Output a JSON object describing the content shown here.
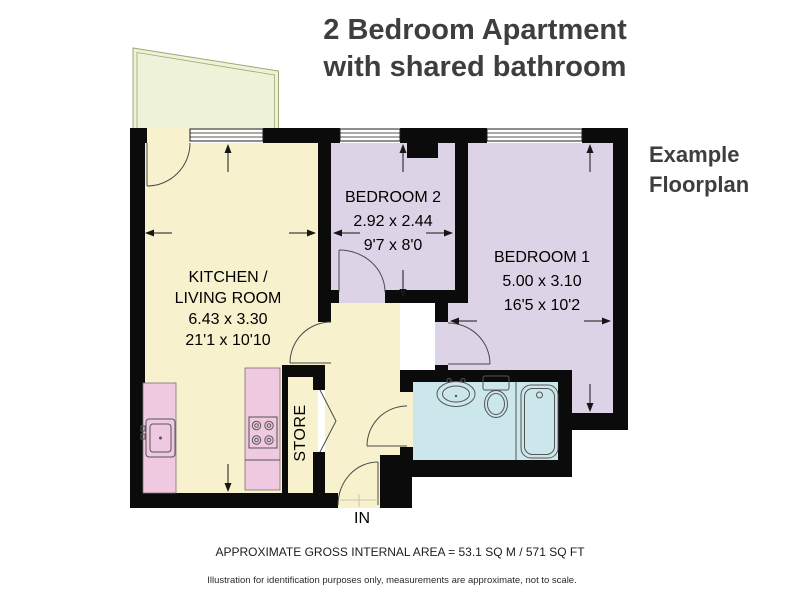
{
  "header": {
    "title_line1": "2 Bedroom Apartment",
    "title_line2": "with shared bathroom"
  },
  "side_note": {
    "line1": "Example",
    "line2": "Floorplan"
  },
  "rooms": {
    "kitchen_living": {
      "name_line1": "KITCHEN /",
      "name_line2": "LIVING ROOM",
      "size_metric": "6.43 x 3.30",
      "size_imperial": "21'1 x 10'10"
    },
    "bedroom2": {
      "name": "BEDROOM 2",
      "size_metric": "2.92 x 2.44",
      "size_imperial": "9'7 x 8'0"
    },
    "bedroom1": {
      "name": "BEDROOM 1",
      "size_metric": "5.00 x 3.10",
      "size_imperial": "16'5 x 10'2"
    },
    "store": {
      "name": "STORE"
    }
  },
  "entrance": {
    "label": "IN"
  },
  "footer": {
    "area_line": "APPROXIMATE GROSS INTERNAL AREA = 53.1 SQ M / 571 SQ FT",
    "disclaimer": "Illustration for identification purposes only, measurements are approximate, not to scale."
  },
  "colors": {
    "wall": "#0b0b0b",
    "floor_cream": "#f8f1cd",
    "floor_lavender": "#dcd4e6",
    "floor_cyan": "#cbe7eb",
    "counter_pink": "#eec9df",
    "balcony_green": "#edf2d8",
    "balcony_stroke": "#a2a674",
    "line": "#4a4a4a",
    "title_text": "#3e3e3e"
  }
}
